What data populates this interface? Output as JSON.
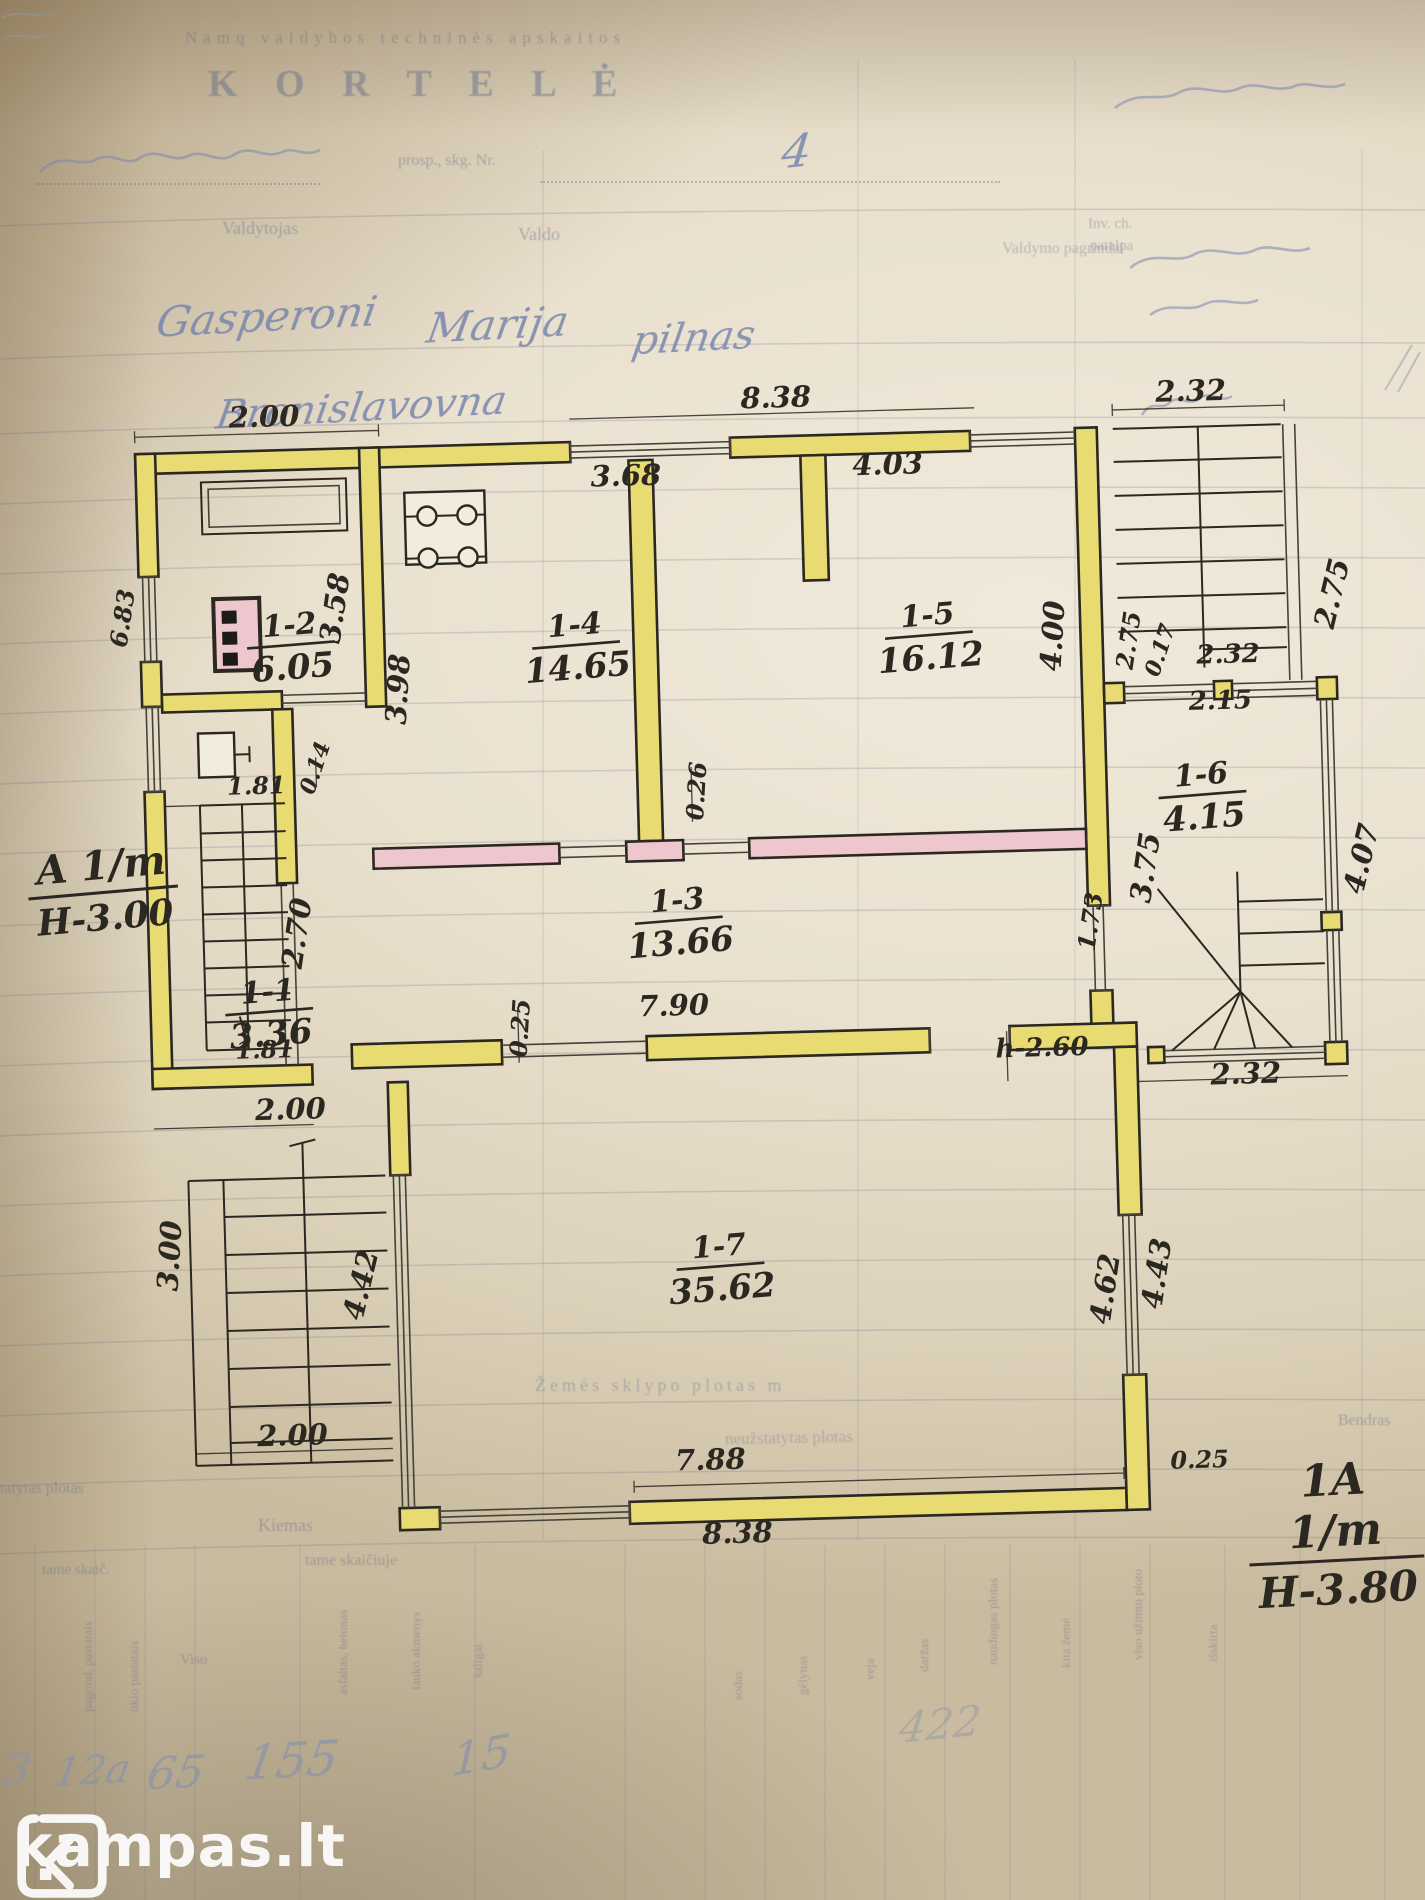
{
  "form": {
    "header_line": "Namų valdybos techninės apskaitos",
    "title": "K O R T E L Ė",
    "address_label": "prosp., skg. Nr.",
    "columns": {
      "valdytojas": "Valdytojas",
      "valdo": "Valdo",
      "valdymo": "Valdymo pagrindai",
      "inv1": "Inv. ch.",
      "inv2": "patalpa"
    },
    "land_area_label": "Žemės sklypo plotas m",
    "unbuilt_label": "neužstatytas plotas",
    "built_label": "Užstatytas plotas",
    "yard_label": "Kiemas",
    "tame_skaic": "tame skaič.",
    "tame_skaiciuje": "tame skaičiuje",
    "viso_label": "Viso",
    "bendras_label": "Bendras",
    "rot_cols_left": [
      "pagrind. pastatais",
      "ūkio pastatais"
    ],
    "rot_cols_mid": [
      "asfaltas, betonas",
      "lauko akmenys",
      "šaligat."
    ],
    "rot_cols_right": [
      "sodas",
      "gėlynas",
      "veja",
      "daržas",
      "naudingas plotas",
      "kita žemė",
      "viso užimto ploto",
      "išskirta"
    ]
  },
  "handwriting": {
    "house_no": "4",
    "owner_first": "Gasperoni",
    "owner_middle": "Marija",
    "owner_note": "pilnas",
    "owner_patronymic": "Bronislavovna",
    "values_row": [
      "3",
      "12a",
      "65",
      "155",
      "15"
    ],
    "green_area_value": "422"
  },
  "plan": {
    "ink_color": "#2b2721",
    "wall_color_yellow": "#e8db72",
    "wall_color_pink": "#eec6cd",
    "sections": {
      "left1": "A 1/m",
      "left2": "H-3.00",
      "right1": "1A 1/m",
      "right2": "H-3.80"
    },
    "rooms": [
      {
        "id": "1-2",
        "area": "6.05",
        "x": 300,
        "y": 622
      },
      {
        "id": "1-4",
        "area": "14.65",
        "x": 585,
        "y": 630
      },
      {
        "id": "1-5",
        "area": "16.12",
        "x": 938,
        "y": 630
      },
      {
        "id": "1-6",
        "area": "4.15",
        "x": 1207,
        "y": 797
      },
      {
        "id": "1-3",
        "area": "13.66",
        "x": 680,
        "y": 908
      },
      {
        "id": "1-1",
        "area": "3.36",
        "x": 268,
        "y": 988
      },
      {
        "id": "1-7",
        "area": "35.62",
        "x": 712,
        "y": 1255
      }
    ],
    "dimensions": [
      {
        "t": "2.00",
        "x": 280,
        "y": 413
      },
      {
        "t": "8.38",
        "x": 792,
        "y": 408
      },
      {
        "t": "2.32",
        "x": 1207,
        "y": 413
      },
      {
        "t": "3.68",
        "x": 640,
        "y": 482
      },
      {
        "t": "4.03",
        "x": 902,
        "y": 478
      },
      {
        "t": "2.75",
        "x": 1352,
        "y": 612,
        "r": -75
      },
      {
        "t": "3.58",
        "x": 355,
        "y": 598,
        "r": -80
      },
      {
        "t": "3.98",
        "x": 416,
        "y": 680,
        "r": -85
      },
      {
        "t": "4.00",
        "x": 1072,
        "y": 645,
        "r": -85
      },
      {
        "t": "2.75",
        "x": 1146,
        "y": 652,
        "r": -80,
        "s": 24
      },
      {
        "t": "0.17",
        "x": 1176,
        "y": 664,
        "r": -70,
        "s": 22
      },
      {
        "t": "2.32",
        "x": 1237,
        "y": 676,
        "s": 26
      },
      {
        "t": "2.15",
        "x": 1228,
        "y": 722,
        "s": 26
      },
      {
        "t": "4.07",
        "x": 1374,
        "y": 878,
        "r": -75
      },
      {
        "t": "6.83",
        "x": 141,
        "y": 602,
        "r": -80,
        "s": 24
      },
      {
        "t": "1.81",
        "x": 262,
        "y": 780,
        "s": 24
      },
      {
        "t": "0.14",
        "x": 328,
        "y": 758,
        "r": -70,
        "s": 22
      },
      {
        "t": "2.70",
        "x": 308,
        "y": 922,
        "r": -80
      },
      {
        "t": "0.26",
        "x": 710,
        "y": 790,
        "r": -85,
        "s": 24
      },
      {
        "t": "0.25",
        "x": 527,
        "y": 1022,
        "r": -85,
        "s": 24
      },
      {
        "t": "7.90",
        "x": 673,
        "y": 1013
      },
      {
        "t": "h-2.60",
        "x": 1040,
        "y": 1064,
        "s": 26
      },
      {
        "t": "1.73",
        "x": 1100,
        "y": 932,
        "r": -80,
        "s": 24
      },
      {
        "t": "3.75",
        "x": 1158,
        "y": 880,
        "r": -80
      },
      {
        "t": "2.32",
        "x": 1243,
        "y": 1097
      },
      {
        "t": "4.62",
        "x": 1106,
        "y": 1300,
        "r": -80
      },
      {
        "t": "4.43",
        "x": 1158,
        "y": 1286,
        "r": -80
      },
      {
        "t": "0.25",
        "x": 1186,
        "y": 1480,
        "s": 24
      },
      {
        "t": "1.81",
        "x": 263,
        "y": 1044,
        "s": 24
      },
      {
        "t": "2.00",
        "x": 287,
        "y": 1106
      },
      {
        "t": "3.00",
        "x": 172,
        "y": 1240,
        "r": -85
      },
      {
        "t": "4.42",
        "x": 362,
        "y": 1276,
        "r": -75
      },
      {
        "t": "2.00",
        "x": 280,
        "y": 1432
      },
      {
        "t": "7.88",
        "x": 697,
        "y": 1468
      },
      {
        "t": "8.38",
        "x": 722,
        "y": 1542
      }
    ]
  },
  "watermark": {
    "brand": "kampas.lt"
  }
}
